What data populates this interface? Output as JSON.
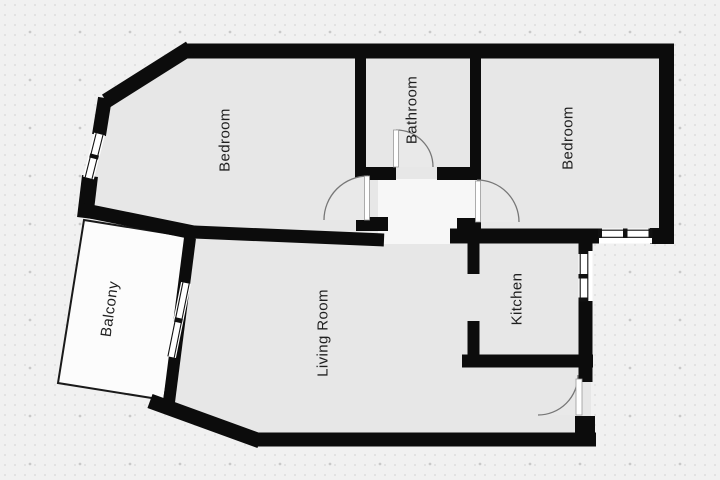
{
  "diagram": {
    "type": "floor-plan",
    "rooms": [
      {
        "id": "bedroom-left",
        "label": "Bedroom"
      },
      {
        "id": "bathroom",
        "label": "Bathroom"
      },
      {
        "id": "bedroom-right",
        "label": "Bedroom"
      },
      {
        "id": "living-room",
        "label": "Living Room"
      },
      {
        "id": "kitchen",
        "label": "Kitchen"
      },
      {
        "id": "balcony",
        "label": "Balcony"
      }
    ],
    "features": {
      "doors": 4,
      "windows": 4
    },
    "colors": {
      "background": "#f1f1f1",
      "wall": "#0c0c0c",
      "room_fill": "#e7e7e7",
      "balcony_fill": "#fcfcfc",
      "hall_fill": "#f7f7f7",
      "door_arc": "#777777",
      "label_text": "#1f1f1f"
    }
  }
}
